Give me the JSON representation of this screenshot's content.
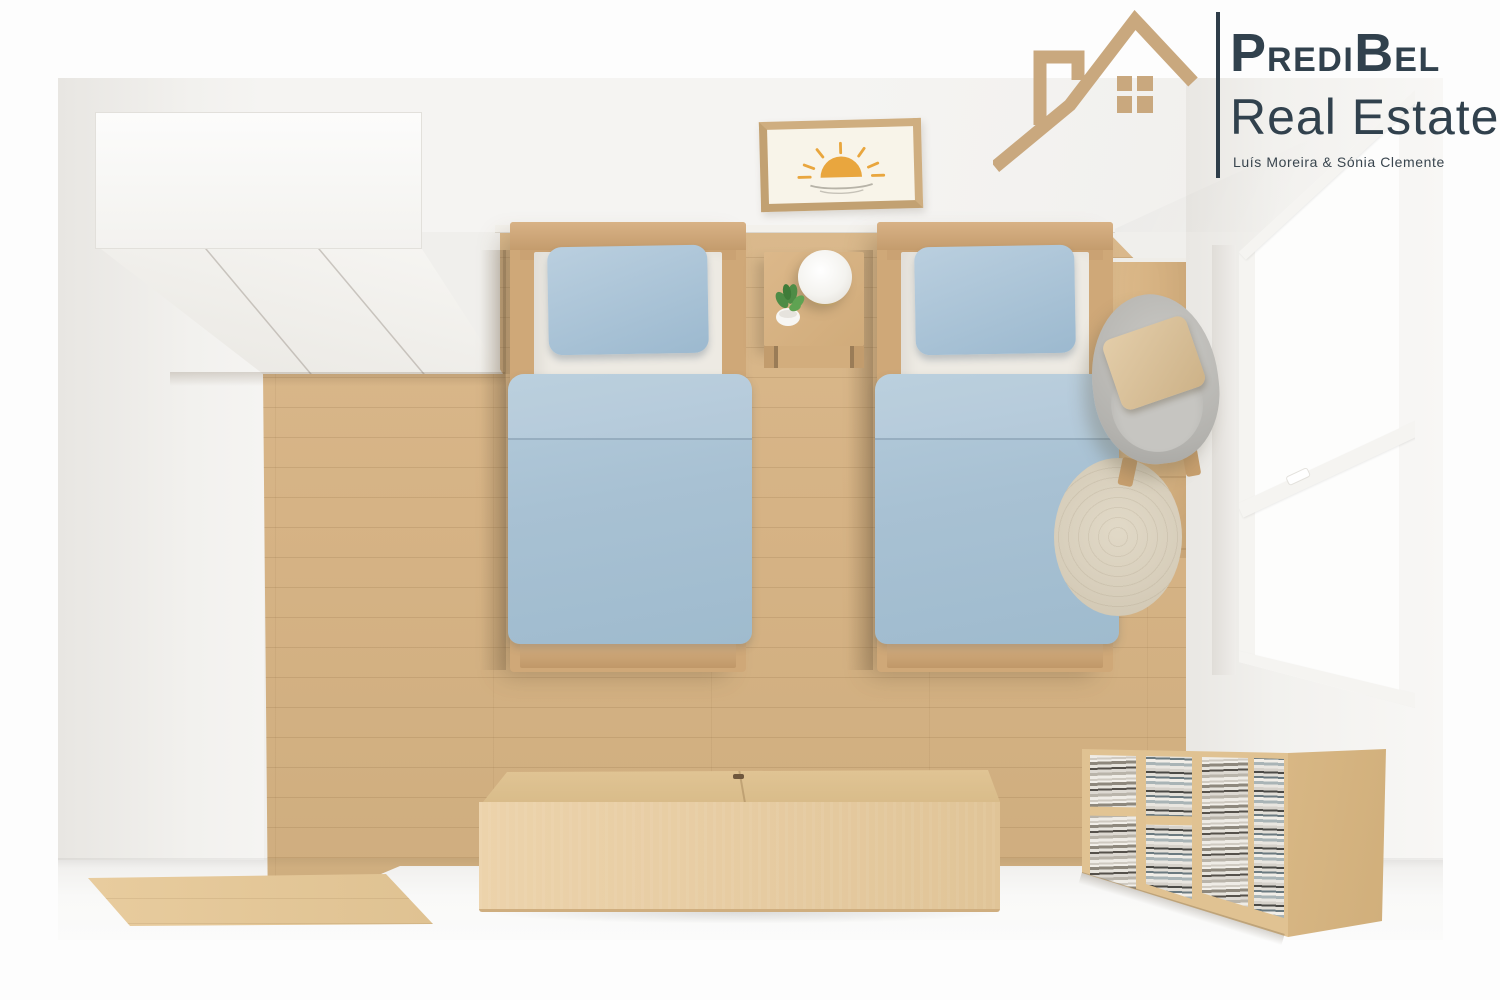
{
  "brand": {
    "wordmark": {
      "p": "P",
      "redi": "redi",
      "b": "B",
      "el": "el"
    },
    "line2": "Real Estate",
    "tagline": "Luís Moreira & Sónia Clemente",
    "icon": "house-roof-icon",
    "colors": {
      "tan": "#c9a87e",
      "dark": "#31414d"
    }
  },
  "scene": {
    "view": "top-down 3D render of a twin bedroom",
    "items": [
      "wardrobe",
      "twin-bed-left",
      "twin-bed-right",
      "blue-duvet",
      "blue-pillow",
      "nightstand",
      "table-lamp",
      "potted-plant",
      "sun-wall-art",
      "wood-door",
      "window",
      "gray-armchair",
      "beige-cushion",
      "round-rug",
      "bookshelf",
      "storage-bench",
      "wood-floor"
    ],
    "palette": {
      "wood_floor": "#d7b586",
      "wood_light": "#e6cda4",
      "wood_mid": "#cfa977",
      "wall": "#f1f0ed",
      "wall_shade": "#e9e7e3",
      "backdrop": "#fdfdfd",
      "duvet_blue": "#a9c2d4",
      "pillow_blue": "#a5c0d3",
      "mattress": "#edeae3",
      "chair_gray": "#b7b6b2",
      "cushion_tan": "#d8c19c",
      "rug_beige": "#d9d0bd",
      "sun_orange": "#e9a63e",
      "leaf_green": "#4e8c46"
    }
  }
}
